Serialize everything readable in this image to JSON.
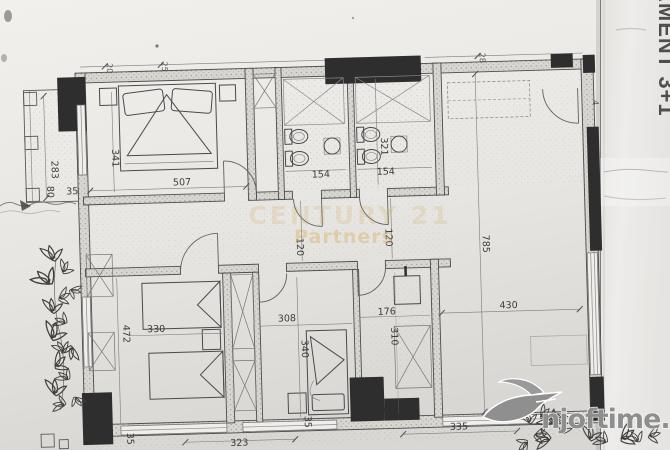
{
  "labels": {
    "side_text": "AMENT 3+1"
  },
  "watermark": {
    "line1": "CENTURY 21",
    "line2": "Partners",
    "color": "#d5a64a"
  },
  "logo": {
    "text": "njoftime.al",
    "color": "#8e8e8e"
  },
  "dimensions": [
    "283",
    "341",
    "80",
    "35",
    "507",
    "154",
    "321",
    "154",
    "785",
    "430",
    "120",
    "120",
    "472",
    "330",
    "308",
    "340",
    "176",
    "310",
    "323",
    "335",
    "35",
    "35",
    "20",
    "25",
    "28",
    "4"
  ],
  "colors": {
    "paper": "#eceae6",
    "ink": "#3a3a3a",
    "structural_wall": "#2e2e2e",
    "watermark_gold": "#d5a64a",
    "logo_gray": "#8e8e8e"
  }
}
